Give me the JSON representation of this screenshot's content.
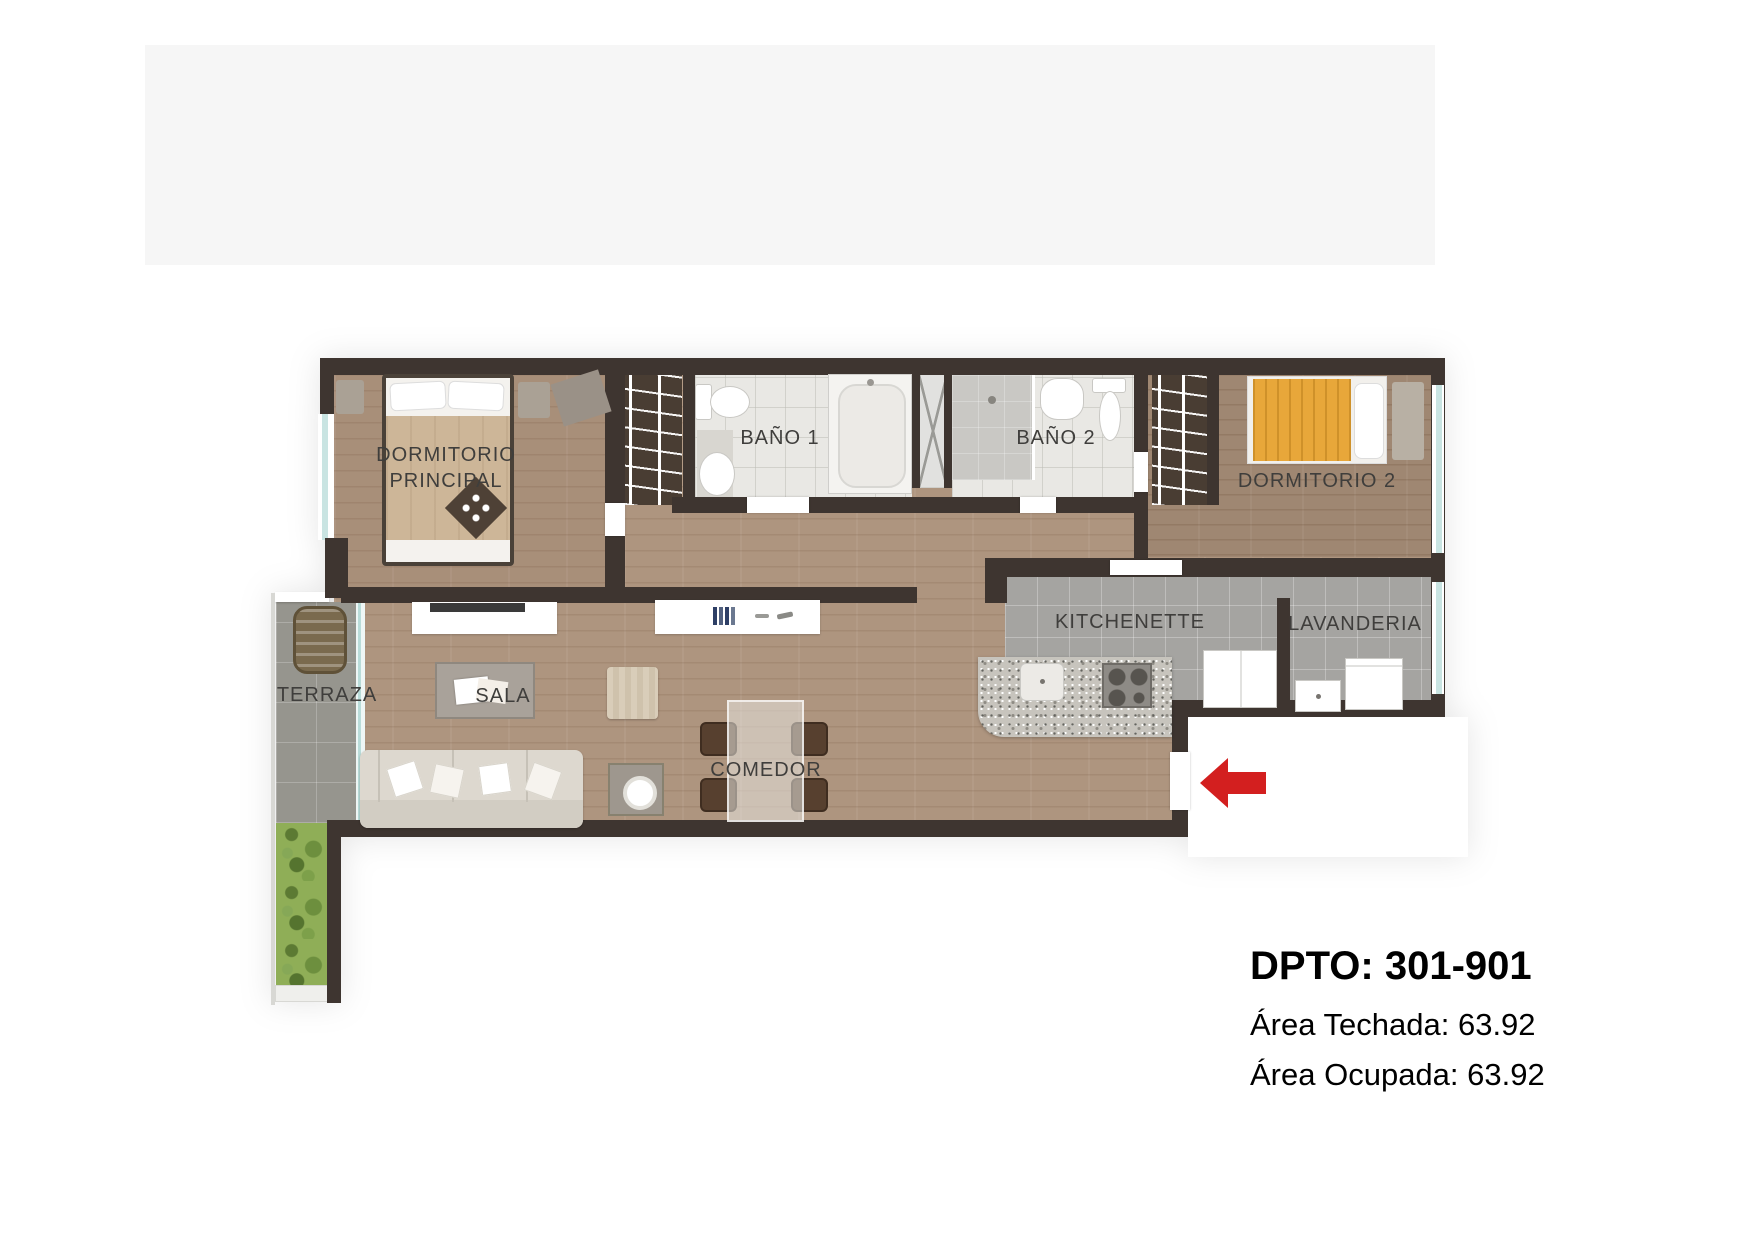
{
  "rooms": {
    "dormitorio_principal": {
      "label_line1": "DORMITORIO",
      "label_line2": "PRINCIPAL"
    },
    "bano_1": {
      "label": "BAÑO 1"
    },
    "bano_2": {
      "label": "BAÑO 2"
    },
    "dormitorio_2": {
      "label": "DORMITORIO 2"
    },
    "kitchenette": {
      "label": "KITCHENETTE"
    },
    "lavanderia": {
      "label": "LAVANDERIA"
    },
    "terraza": {
      "label": "TERRAZA"
    },
    "sala": {
      "label": "SALA"
    },
    "comedor": {
      "label": "COMEDOR"
    }
  },
  "info": {
    "title": "DPTO: 301-901",
    "area_techada": "Área Techada: 63.92",
    "area_ocupada": "Área Ocupada: 63.92"
  },
  "icons": {
    "entrance_arrow": "left-arrow"
  },
  "colors": {
    "wall": "#3e3530",
    "wood": "#ae957f",
    "wood_dark": "#9f8772",
    "tile_gray": "#a5a4a1",
    "terraza_tile": "#96958e",
    "bath_tile": "#e9e8e4",
    "accent_red": "#d31f1f",
    "plant_green": "#8fae57",
    "blanket_yellow": "#e8a73a",
    "blanket_tan": "#cdb698",
    "text": "#3f3e3c"
  }
}
